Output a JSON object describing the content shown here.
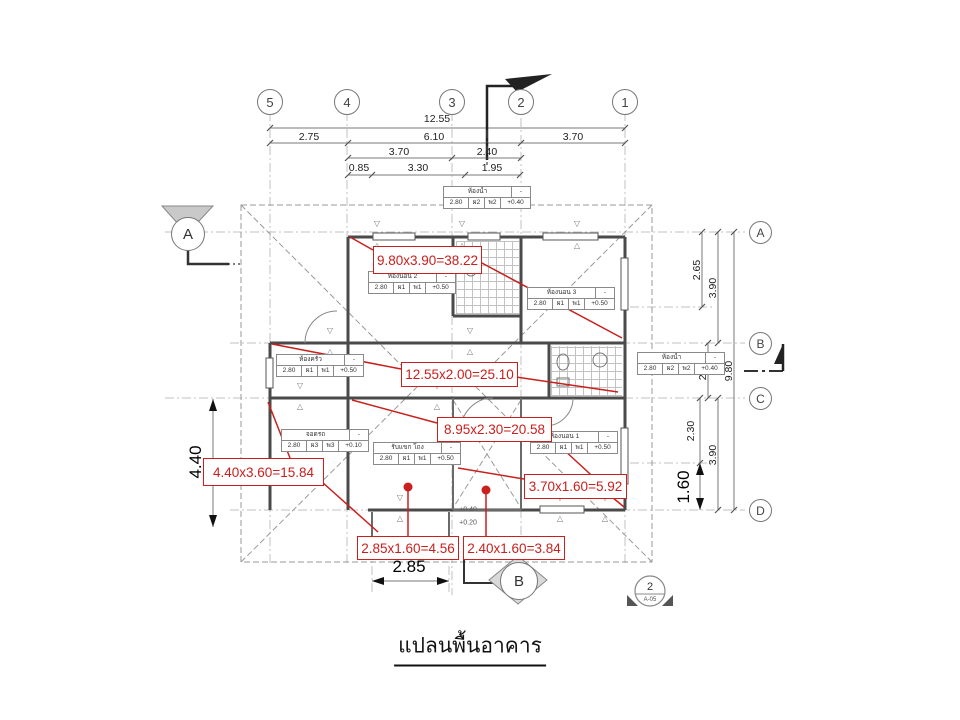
{
  "title": "แปลนพื้นอาคาร",
  "colors": {
    "annotation_red": "#c9201d",
    "wall_gray": "#4a4a4a",
    "line_gray": "#888888"
  },
  "grid": {
    "top_bubbles": [
      {
        "label": "5",
        "x": 270
      },
      {
        "label": "4",
        "x": 347
      },
      {
        "label": "3",
        "x": 452
      },
      {
        "label": "2",
        "x": 521
      },
      {
        "label": "1",
        "x": 625
      }
    ],
    "right_bubbles": [
      {
        "label": "A",
        "y": 232
      },
      {
        "label": "B",
        "y": 343
      },
      {
        "label": "C",
        "y": 398
      },
      {
        "label": "D",
        "y": 510
      }
    ]
  },
  "dimensions": {
    "top": [
      {
        "text": "12.55",
        "x": 437,
        "y": 119
      },
      {
        "text": "2.75",
        "x": 309,
        "y": 137
      },
      {
        "text": "6.10",
        "x": 434,
        "y": 137
      },
      {
        "text": "3.70",
        "x": 573,
        "y": 137
      },
      {
        "text": "3.70",
        "x": 399,
        "y": 152
      },
      {
        "text": "2.40",
        "x": 487,
        "y": 152
      },
      {
        "text": "0.85",
        "x": 359,
        "y": 168
      },
      {
        "text": "3.30",
        "x": 418,
        "y": 168
      },
      {
        "text": "1.95",
        "x": 492,
        "y": 168
      }
    ],
    "right": [
      {
        "text": "2.65",
        "x": 697,
        "y": 270,
        "rot": true
      },
      {
        "text": "3.90",
        "x": 713,
        "y": 288,
        "rot": true
      },
      {
        "text": "2.00",
        "x": 703,
        "y": 370,
        "rot": true
      },
      {
        "text": "9.80",
        "x": 729,
        "y": 371,
        "rot": true
      },
      {
        "text": "2.30",
        "x": 691,
        "y": 431,
        "rot": true
      },
      {
        "text": "3.90",
        "x": 713,
        "y": 455,
        "rot": true
      },
      {
        "text": "1.60",
        "x": 684,
        "y": 487,
        "rot": true,
        "big": true
      }
    ],
    "left": [
      {
        "text": "4.40",
        "x": 196,
        "y": 462,
        "rot": true,
        "big": true
      }
    ],
    "bottom": [
      {
        "text": "2.85",
        "x": 409,
        "y": 567,
        "big": true
      }
    ]
  },
  "annotations": [
    {
      "text": "9.80x3.90=38.22",
      "x": 373,
      "y": 246,
      "w": 107,
      "h": 26
    },
    {
      "text": "12.55x2.00=25.10",
      "x": 401,
      "y": 362,
      "w": 115,
      "h": 23
    },
    {
      "text": "8.95x2.30=20.58",
      "x": 437,
      "y": 417,
      "w": 113,
      "h": 23
    },
    {
      "text": "4.40x3.60=15.84",
      "x": 203,
      "y": 458,
      "w": 119,
      "h": 26
    },
    {
      "text": "3.70x1.60=5.92",
      "x": 524,
      "y": 474,
      "w": 101,
      "h": 23
    },
    {
      "text": "2.85x1.60=4.56",
      "x": 357,
      "y": 536,
      "w": 100,
      "h": 22
    },
    {
      "text": "2.40x1.60=3.84",
      "x": 463,
      "y": 536,
      "w": 100,
      "h": 22
    }
  ],
  "rooms": [
    {
      "name": "ห้องน้ำ",
      "cells": [
        "2.80",
        "ผ2",
        "พ2",
        "+0.40"
      ],
      "x": 443,
      "y": 186
    },
    {
      "name": "ห้องนอน 2",
      "cells": [
        "2.80",
        "ผ1",
        "พ1",
        "+0.50"
      ],
      "x": 368,
      "y": 271
    },
    {
      "name": "ห้องนอน 3",
      "cells": [
        "2.80",
        "ผ1",
        "พ1",
        "+0.50"
      ],
      "x": 527,
      "y": 287
    },
    {
      "name": "ห้องครัว",
      "cells": [
        "2.80",
        "ผ1",
        "พ1",
        "+0.50"
      ],
      "x": 276,
      "y": 354
    },
    {
      "name": "ห้องน้ำ",
      "cells": [
        "2.80",
        "ผ2",
        "พ2",
        "+0.40"
      ],
      "x": 637,
      "y": 352
    },
    {
      "name": "จอดรถ",
      "cells": [
        "2.80",
        "ผ3",
        "พ3",
        "+0.10"
      ],
      "x": 281,
      "y": 429
    },
    {
      "name": "รับแขก โถง",
      "cells": [
        "2.80",
        "ผ1",
        "พ1",
        "+0.50"
      ],
      "x": 373,
      "y": 442
    },
    {
      "name": "ห้องนอน 1",
      "cells": [
        "2.80",
        "ผ1",
        "พ1",
        "+0.50"
      ],
      "x": 530,
      "y": 431
    }
  ],
  "levels": [
    {
      "text": "+0.40",
      "x": 468,
      "y": 510
    },
    {
      "text": "+0.20",
      "x": 468,
      "y": 523
    }
  ],
  "window_tags": [
    {
      "x": 377,
      "y": 224
    },
    {
      "x": 377,
      "y": 246
    },
    {
      "x": 462,
      "y": 224
    },
    {
      "x": 462,
      "y": 246
    },
    {
      "x": 577,
      "y": 224
    },
    {
      "x": 577,
      "y": 246
    },
    {
      "x": 330,
      "y": 331
    },
    {
      "x": 330,
      "y": 352
    },
    {
      "x": 470,
      "y": 331
    },
    {
      "x": 470,
      "y": 352
    },
    {
      "x": 300,
      "y": 386
    },
    {
      "x": 300,
      "y": 407
    },
    {
      "x": 437,
      "y": 386
    },
    {
      "x": 437,
      "y": 407
    },
    {
      "x": 400,
      "y": 498
    },
    {
      "x": 400,
      "y": 519
    },
    {
      "x": 560,
      "y": 498
    },
    {
      "x": 560,
      "y": 519
    },
    {
      "x": 605,
      "y": 498
    },
    {
      "x": 605,
      "y": 519
    }
  ],
  "markers": {
    "section_a_label": "A",
    "section_b_label": "B",
    "detail_number": "2",
    "detail_sheet": "A-05"
  }
}
